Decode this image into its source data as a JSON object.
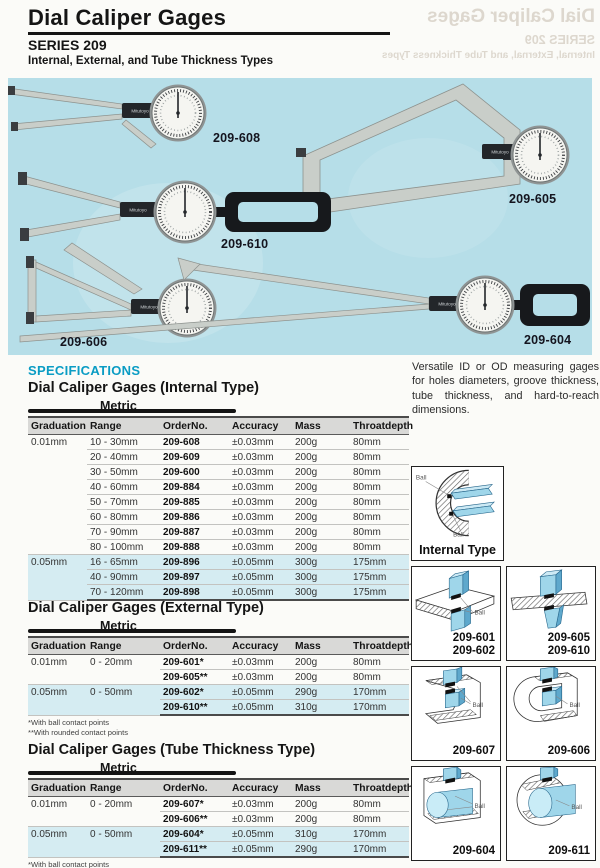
{
  "header": {
    "title": "Dial Caliper Gages",
    "series": "SERIES 209",
    "subtitle": "Internal, External, and Tube Thickness Types"
  },
  "hero": {
    "brand": "Mitutoyo",
    "labels": [
      "209-608",
      "209-605",
      "209-610",
      "209-606",
      "209-604"
    ]
  },
  "intro": "Versatile ID or OD measuring gages for holes diameters, groove thickness, tube thickness, and hard-to-reach dimensions.",
  "specifications": {
    "heading": "SPECIFICATIONS",
    "tables": [
      {
        "title": "Dial Caliper Gages (Internal Type)",
        "tab": "Metric",
        "columns": [
          "Graduation",
          "Range",
          "OrderNo.",
          "Accuracy",
          "Mass",
          "Throatdepth"
        ],
        "groups": [
          {
            "graduation": "0.01mm",
            "highlight": false,
            "rows": [
              {
                "range": "10 - 30mm",
                "order": "209-608",
                "accuracy": "±0.03mm",
                "mass": "200g",
                "throat": "80mm"
              },
              {
                "range": "20 - 40mm",
                "order": "209-609",
                "accuracy": "±0.03mm",
                "mass": "200g",
                "throat": "80mm"
              },
              {
                "range": "30 - 50mm",
                "order": "209-600",
                "accuracy": "±0.03mm",
                "mass": "200g",
                "throat": "80mm"
              },
              {
                "range": "40 - 60mm",
                "order": "209-884",
                "accuracy": "±0.03mm",
                "mass": "200g",
                "throat": "80mm"
              },
              {
                "range": "50 - 70mm",
                "order": "209-885",
                "accuracy": "±0.03mm",
                "mass": "200g",
                "throat": "80mm"
              },
              {
                "range": "60 - 80mm",
                "order": "209-886",
                "accuracy": "±0.03mm",
                "mass": "200g",
                "throat": "80mm"
              },
              {
                "range": "70 - 90mm",
                "order": "209-887",
                "accuracy": "±0.03mm",
                "mass": "200g",
                "throat": "80mm"
              },
              {
                "range": "80 - 100mm",
                "order": "209-888",
                "accuracy": "±0.03mm",
                "mass": "200g",
                "throat": "80mm"
              }
            ]
          },
          {
            "graduation": "0.05mm",
            "highlight": true,
            "rows": [
              {
                "range": "16 - 65mm",
                "order": "209-896",
                "accuracy": "±0.05mm",
                "mass": "300g",
                "throat": "175mm"
              },
              {
                "range": "40 - 90mm",
                "order": "209-897",
                "accuracy": "±0.05mm",
                "mass": "300g",
                "throat": "175mm"
              },
              {
                "range": "70 - 120mm",
                "order": "209-898",
                "accuracy": "±0.05mm",
                "mass": "300g",
                "throat": "175mm"
              }
            ]
          }
        ],
        "footnotes": []
      },
      {
        "title": "Dial Caliper Gages (External Type)",
        "tab": "Metric",
        "columns": [
          "Graduation",
          "Range",
          "OrderNo.",
          "Accuracy",
          "Mass",
          "Throatdepth"
        ],
        "groups": [
          {
            "graduation": "0.01mm",
            "range": "0 - 20mm",
            "highlight": false,
            "rows": [
              {
                "order": "209-601*",
                "accuracy": "±0.03mm",
                "mass": "200g",
                "throat": "80mm"
              },
              {
                "order": "209-605**",
                "accuracy": "±0.03mm",
                "mass": "200g",
                "throat": "80mm"
              }
            ]
          },
          {
            "graduation": "0.05mm",
            "range": "0 - 50mm",
            "highlight": true,
            "rows": [
              {
                "order": "209-602*",
                "accuracy": "±0.05mm",
                "mass": "290g",
                "throat": "170mm"
              },
              {
                "order": "209-610**",
                "accuracy": "±0.05mm",
                "mass": "310g",
                "throat": "170mm"
              }
            ]
          }
        ],
        "footnotes": [
          "*With ball contact points",
          "**With rounded contact points"
        ]
      },
      {
        "title": "Dial Caliper Gages (Tube Thickness Type)",
        "tab": "Metric",
        "columns": [
          "Graduation",
          "Range",
          "OrderNo.",
          "Accuracy",
          "Mass",
          "Throatdepth"
        ],
        "groups": [
          {
            "graduation": "0.01mm",
            "range": "0 - 20mm",
            "highlight": false,
            "rows": [
              {
                "order": "209-607*",
                "accuracy": "±0.03mm",
                "mass": "200g",
                "throat": "80mm"
              },
              {
                "order": "209-606**",
                "accuracy": "±0.03mm",
                "mass": "200g",
                "throat": "80mm"
              }
            ]
          },
          {
            "graduation": "0.05mm",
            "range": "0 - 50mm",
            "highlight": true,
            "rows": [
              {
                "order": "209-604*",
                "accuracy": "±0.05mm",
                "mass": "310g",
                "throat": "170mm"
              },
              {
                "order": "209-611**",
                "accuracy": "±0.05mm",
                "mass": "290g",
                "throat": "170mm"
              }
            ]
          }
        ],
        "footnotes": [
          "*With ball contact points",
          "**With rounded contact points"
        ]
      }
    ]
  },
  "diagrams": {
    "ball": "Ball",
    "internal_caption": "Internal Type",
    "boxes": [
      {
        "lines": [
          "209-601",
          "209-602"
        ]
      },
      {
        "lines": [
          "209-605",
          "209-610"
        ]
      },
      {
        "lines": [
          "209-607"
        ]
      },
      {
        "lines": [
          "209-606"
        ]
      },
      {
        "lines": [
          "209-604"
        ]
      },
      {
        "lines": [
          "209-611"
        ]
      }
    ]
  }
}
